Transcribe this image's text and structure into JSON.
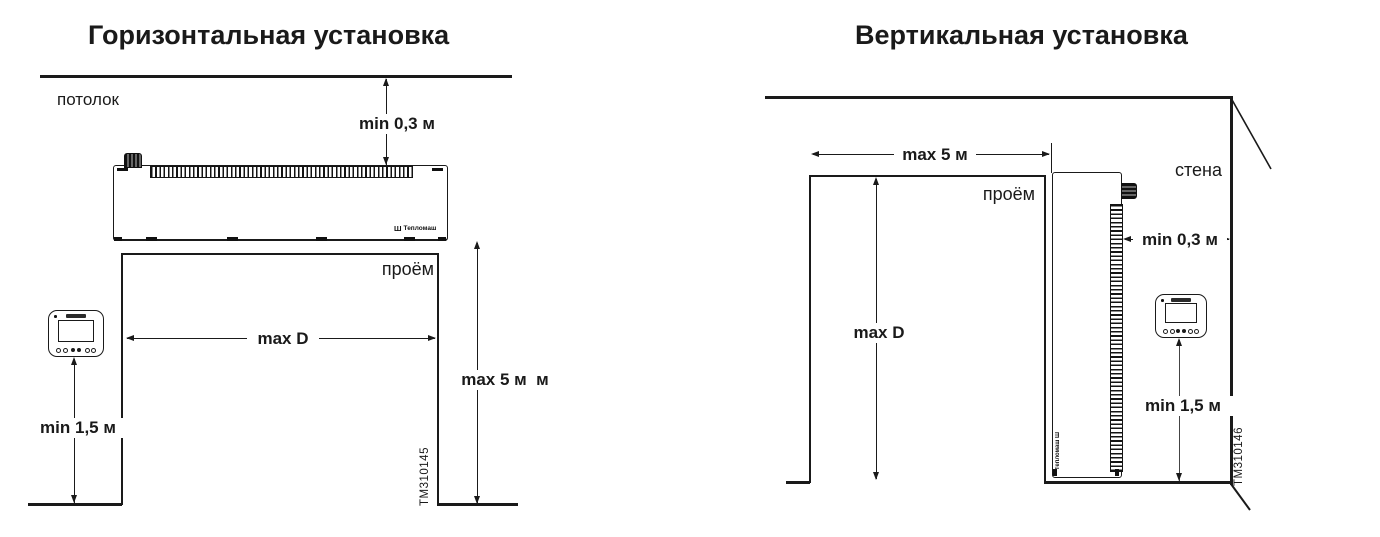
{
  "page": {
    "background": "#ffffff",
    "line_color": "#1a1a1a"
  },
  "left": {
    "title": "Горизонтальная установка",
    "ceiling_label": "потолок",
    "opening_label": "проём",
    "dim_ceiling_clearance": "min 0,3 м",
    "dim_opening_width": "max D",
    "dim_opening_height": "max 5 м  м",
    "dim_remote_height": "min 1,5 м",
    "drawing_code": "TM310145",
    "unit_logo": "Тепломаш",
    "trident_icon": "Ш"
  },
  "right": {
    "title": "Вертикальная установка",
    "wall_label": "стена",
    "opening_label": "проём",
    "dim_opening_width": "max 5 м",
    "dim_wall_clearance": "min 0,3 м",
    "dim_opening_height": "max D",
    "dim_remote_height": "min 1,5 м",
    "drawing_code": "TM310146",
    "unit_logo": "Тепломаш",
    "trident_icon": "Ш"
  }
}
